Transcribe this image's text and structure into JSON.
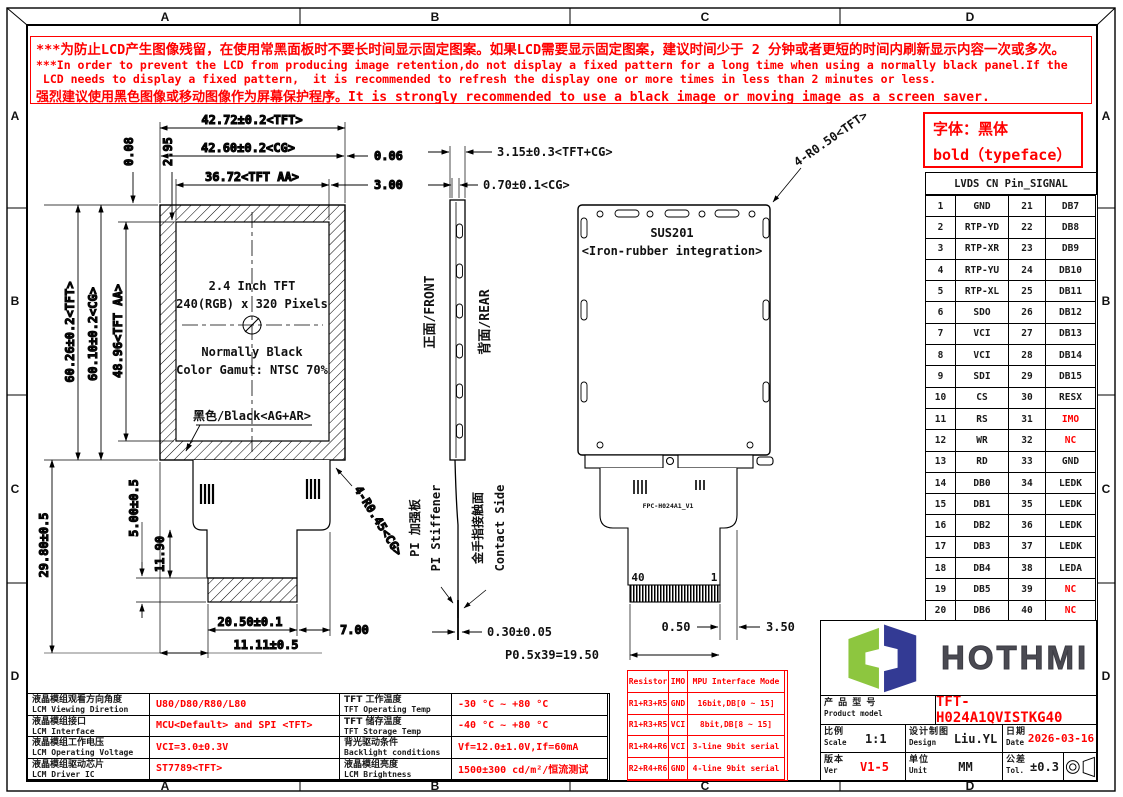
{
  "frame": {
    "zones": [
      "A",
      "B",
      "C",
      "D"
    ]
  },
  "warning": {
    "l1": "***为防止LCD产生图像残留，在使用常黑面板时不要长时间显示固定图案。如果LCD需要显示固定图案，建议时间少于 2 分钟或者更短的时间内刷新显示内容一次或多次。",
    "l2": "***In order to prevent the LCD from producing image retention,do not display a fixed pattern for a long time when using a normally black panel.If the",
    "l3": " LCD needs to display a fixed pattern,  it is recommended to refresh the display one or more times in less than 2 minutes or less.",
    "l4": "强烈建议使用黑色图像或移动图像作为屏幕保护程序。It is strongly recommended to use a black image or moving image as a screen saver."
  },
  "typeface_note": {
    "l1": "字体：黑体",
    "l2": "bold（typeface）"
  },
  "pin_table": {
    "title": "LVDS CN Pin_SIGNAL",
    "rows": [
      {
        "p1": "1",
        "s1": "GND",
        "p2": "21",
        "s2": "DB7"
      },
      {
        "p1": "2",
        "s1": "RTP-YD",
        "p2": "22",
        "s2": "DB8"
      },
      {
        "p1": "3",
        "s1": "RTP-XR",
        "p2": "23",
        "s2": "DB9"
      },
      {
        "p1": "4",
        "s1": "RTP-YU",
        "p2": "24",
        "s2": "DB10"
      },
      {
        "p1": "5",
        "s1": "RTP-XL",
        "p2": "25",
        "s2": "DB11"
      },
      {
        "p1": "6",
        "s1": "SDO",
        "p2": "26",
        "s2": "DB12"
      },
      {
        "p1": "7",
        "s1": "VCI",
        "p2": "27",
        "s2": "DB13"
      },
      {
        "p1": "8",
        "s1": "VCI",
        "p2": "28",
        "s2": "DB14"
      },
      {
        "p1": "9",
        "s1": "SDI",
        "p2": "29",
        "s2": "DB15"
      },
      {
        "p1": "10",
        "s1": "CS",
        "p2": "30",
        "s2": "RESX"
      },
      {
        "p1": "11",
        "s1": "RS",
        "p2": "31",
        "s2": "IMO"
      },
      {
        "p1": "12",
        "s1": "WR",
        "p2": "32",
        "s2": "NC"
      },
      {
        "p1": "13",
        "s1": "RD",
        "p2": "33",
        "s2": "GND"
      },
      {
        "p1": "14",
        "s1": "DB0",
        "p2": "34",
        "s2": "LEDK"
      },
      {
        "p1": "15",
        "s1": "DB1",
        "p2": "35",
        "s2": "LEDK"
      },
      {
        "p1": "16",
        "s1": "DB2",
        "p2": "36",
        "s2": "LEDK"
      },
      {
        "p1": "17",
        "s1": "DB3",
        "p2": "37",
        "s2": "LEDK"
      },
      {
        "p1": "18",
        "s1": "DB4",
        "p2": "38",
        "s2": "LEDA"
      },
      {
        "p1": "19",
        "s1": "DB5",
        "p2": "39",
        "s2": "NC"
      },
      {
        "p1": "20",
        "s1": "DB6",
        "p2": "40",
        "s2": "NC"
      }
    ]
  },
  "drawing": {
    "front": {
      "dim_w_tft": "42.72±0.2<TFT>",
      "dim_w_cg": "42.60±0.2<CG>",
      "dim_w_aa": "36.72<TFT AA>",
      "dim_off1": "0.08",
      "dim_off2": "2.95",
      "dim_gap1": "0.06",
      "dim_gap2": "3.00",
      "dim_h_tft": "60.26±0.2<TFT>",
      "dim_h_cg": "60.10±0.2<CG>",
      "dim_h_aa": "48.96<TFT AA>",
      "dim_fpc": "29.80±0.5",
      "dim_contact_h": "5.00±0.5",
      "dim_tail": "11.90",
      "dim_contact_w": "20.50±0.1",
      "dim_contact_off": "7.00",
      "dim_contact_x": "11.11±0.5",
      "radius_fpc": "4-R0.45<CG>",
      "line1": "2.4 Inch TFT",
      "line2": "240(RGB) x 320 Pixels",
      "line3": "Normally Black",
      "line4": "Color Gamut: NTSC 70%",
      "surface": "黑色/Black<AG+AR>"
    },
    "side": {
      "dim_total": "3.15±0.3<TFT+CG>",
      "dim_cg": "0.70±0.1<CG>",
      "front_label": "正面/FRONT",
      "rear_label": "背面/REAR",
      "stiffener_cn": "PI 加强板",
      "stiffener_en": "PI Stiffener",
      "contact_cn": "金手指接触面",
      "contact_en": "Contact Side",
      "dim_thick": "0.30±0.05"
    },
    "rear": {
      "material": "SUS201",
      "material2": "<Iron-rubber integration>",
      "radius": "4-R0.50<TFT>",
      "fpc_label": "FPC-H024A1_V1",
      "pin40": "40",
      "pin1": "1",
      "dim_end": "0.50",
      "dim_margin": "3.50",
      "dim_pitch": "P0.5x39=19.50"
    }
  },
  "spec_table": {
    "rows": [
      {
        "cn": "液晶模组观看方向角度",
        "en": "LCM Viewing Diretion",
        "value": "U80/D80/R80/L80"
      },
      {
        "cn": "液晶模组接口",
        "en": "LCM Interface",
        "value": "MCU<Default> and SPI <TFT>"
      },
      {
        "cn": "液晶模组工作电压",
        "en": "LCM Operating Voltage",
        "value": "VCI=3.0±0.3V"
      },
      {
        "cn": "液晶模组驱动芯片",
        "en": "LCM Driver IC",
        "value": "ST7789<TFT>"
      }
    ],
    "rows2": [
      {
        "cn": "TFT 工作温度",
        "en": "TFT Operating Temp",
        "value": "-30 °C ~ +80 °C"
      },
      {
        "cn": "TFT 储存温度",
        "en": "TFT Storage Temp",
        "value": "-40 °C ~ +80 °C"
      },
      {
        "cn": "背光驱动条件",
        "en": "Backlight conditions",
        "value": "Vf=12.0±1.0V,If=60mA"
      },
      {
        "cn": "液晶模组亮度",
        "en": "LCM Brightness",
        "value": "1500±300 cd/m²/恒流测试"
      }
    ]
  },
  "resistor_table": {
    "header": [
      "Resistor",
      "IMO",
      "MPU Interface Mode"
    ],
    "rows": [
      [
        "R1+R3+R5",
        "GND",
        "16bit,DB[0 ~ 15]"
      ],
      [
        "R1+R3+R5",
        "VCI",
        "8bit,DB[8 ~ 15]"
      ],
      [
        "R1+R4+R6",
        "VCI",
        "3-line 9bit serial"
      ],
      [
        "R2+R4+R6",
        "GND",
        "4-line 9bit serial"
      ]
    ]
  },
  "title_block": {
    "logo_text": "HOTHMI",
    "logo_green": "#8dc63f",
    "logo_navy": "#333a94",
    "product_cn": "产 品 型 号",
    "product_en": "Product model",
    "product_value": "TFT-H024A1QVISTKG40",
    "scale_cn": "比例",
    "scale_en": "Scale",
    "scale_value": "1:1",
    "design_cn": "设计制图",
    "design_en": "Design",
    "design_value": "Liu.YL",
    "date_cn": "日期",
    "date_en": "Date",
    "date_value": "2026-03-16",
    "ver_cn": "版本",
    "ver_en": "Ver",
    "ver_value": "V1-5",
    "unit_cn": "单位",
    "unit_en": "Unit",
    "unit_value": "MM",
    "tol_cn": "公差",
    "tol_en": "Tol.",
    "tol_value": "±0.3"
  },
  "colors": {
    "red": "#ff0000",
    "black": "#1a1a1a"
  }
}
